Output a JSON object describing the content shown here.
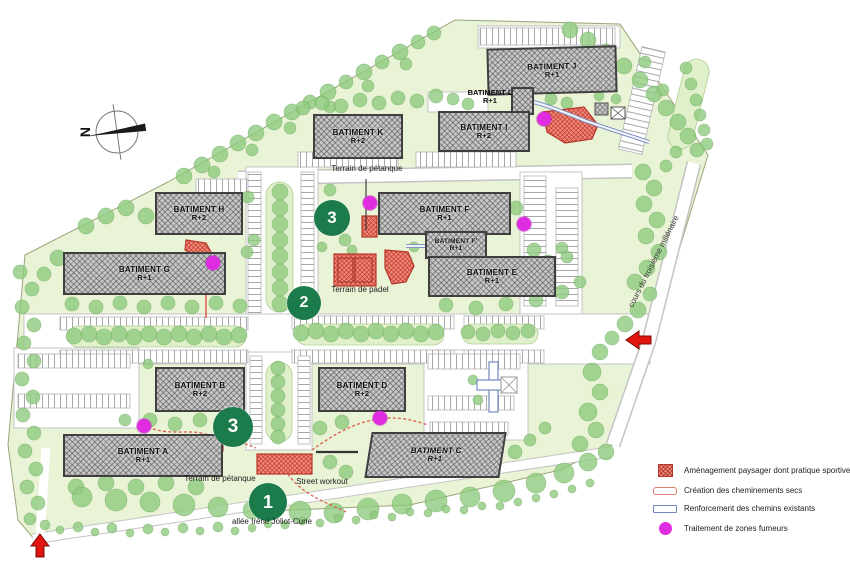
{
  "buildings": [
    {
      "id": "J",
      "label": "BATIMENT J",
      "floors": "R+1"
    },
    {
      "id": "L",
      "label": "BATIMENT L",
      "floors": "R+1"
    },
    {
      "id": "I",
      "label": "BATIMENT I",
      "floors": "R+2"
    },
    {
      "id": "K",
      "label": "BATIMENT K",
      "floors": "R+2"
    },
    {
      "id": "H",
      "label": "BATIMENT H",
      "floors": "R+2"
    },
    {
      "id": "G",
      "label": "BATIMENT G",
      "floors": "R+1"
    },
    {
      "id": "F",
      "label": "BATIMENT F",
      "floors": "R+1"
    },
    {
      "id": "F'",
      "label": "BATIMENT F'",
      "floors": "R+1"
    },
    {
      "id": "E",
      "label": "BATIMENT E",
      "floors": "R+1"
    },
    {
      "id": "B",
      "label": "BATIMENT B",
      "floors": "R+2"
    },
    {
      "id": "D",
      "label": "BATIMENT D",
      "floors": "R+2"
    },
    {
      "id": "A",
      "label": "BATIMENT A",
      "floors": "R+1"
    },
    {
      "id": "C",
      "label": "BATIMENT C",
      "floors": "R+1"
    }
  ],
  "annotations": {
    "petanque_top": "Terrain de pétanque",
    "padel": "Terrain de padel",
    "petanque_bottom": "Terrain de pétanque",
    "street_workout": "Street workout",
    "allee": "allée Irène Joliot-Curie",
    "cours": "cours du troisième millénaire",
    "north": "N"
  },
  "markers": [
    {
      "number": "3",
      "location": "terrain de pétanque nord"
    },
    {
      "number": "2",
      "location": "terrain de padel"
    },
    {
      "number": "3",
      "location": "terrain de pétanque sud"
    },
    {
      "number": "1",
      "location": "street workout"
    }
  ],
  "smoking_zones_count": 6,
  "legend": {
    "items": [
      {
        "swatch": "red-hatch",
        "label": "Aménagement paysager dont pratique sportive"
      },
      {
        "swatch": "pink-path",
        "label": "Création des cheminements secs"
      },
      {
        "swatch": "blue-path",
        "label": "Renforcement des chemins existants"
      },
      {
        "swatch": "magenta-dot",
        "label": "Traitement de zones fumeurs"
      }
    ]
  },
  "colors": {
    "site_green": "#e9f3d6",
    "tree_green": "#8fca7e",
    "building_gray": "#c7c7c7",
    "red_area": "#ef8a7c",
    "magenta": "#e02ce0",
    "marker_green": "#1b7b4a",
    "arrow_red": "#e2150e",
    "path_blue": "#7588bd",
    "path_pink": "#d95f4b"
  }
}
